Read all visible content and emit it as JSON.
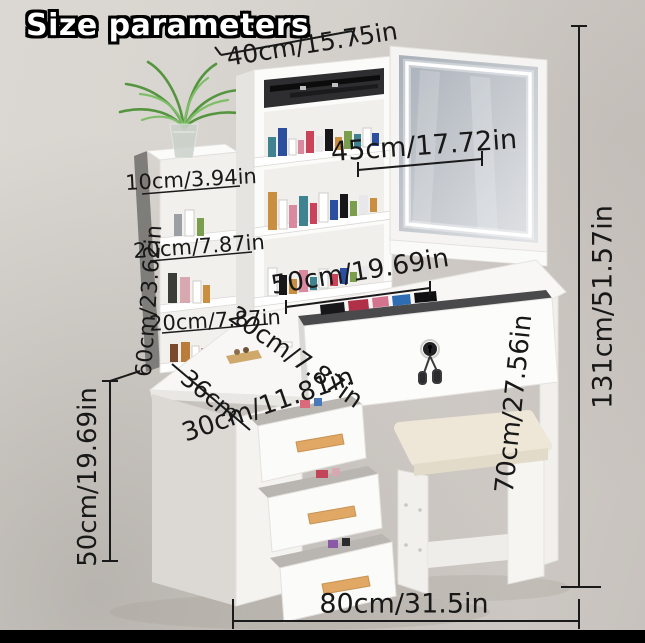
{
  "title": "Size parameters",
  "dims": {
    "top_width": "40cm/15.75in",
    "mirror_width": "45cm/17.72in",
    "side_shelf_depth": "10cm/3.94in",
    "upper_shelf_gap": "20cm/7.87in",
    "side_shelf_height": "60cm/23.62in",
    "lower_shelf_gap": "20cm/7.87in",
    "desktop_width": "50cm/19.69in",
    "drawer_depth": "20cm/7.87in",
    "desk_side_depth": "36cm",
    "desktop_depth": "30cm/11.81in",
    "cabinet_height": "50cm/19.69in",
    "desk_height": "70cm/27.56in",
    "total_height": "131cm/51.57in",
    "total_width": "80cm/31.5in"
  },
  "colors": {
    "background": "#d6d2cd",
    "furniture_white": "#fbfbfa",
    "label_text": "#181818",
    "handle_wood": "#e0a765",
    "cushion": "#eee7d7",
    "plant_green": "#5d9e49",
    "led_strip": "#ffffff",
    "mirror_glass": "#c3c8cd",
    "bottom_bar": "#000000"
  },
  "scene_objects": [
    "vanity-hutch-with-cosmetics",
    "led-mirror-sliding-door",
    "side-shelf-unit",
    "potted-fern-plant",
    "desktop",
    "locked-drawer-with-keys",
    "three-open-drawers",
    "vanity-stool"
  ]
}
